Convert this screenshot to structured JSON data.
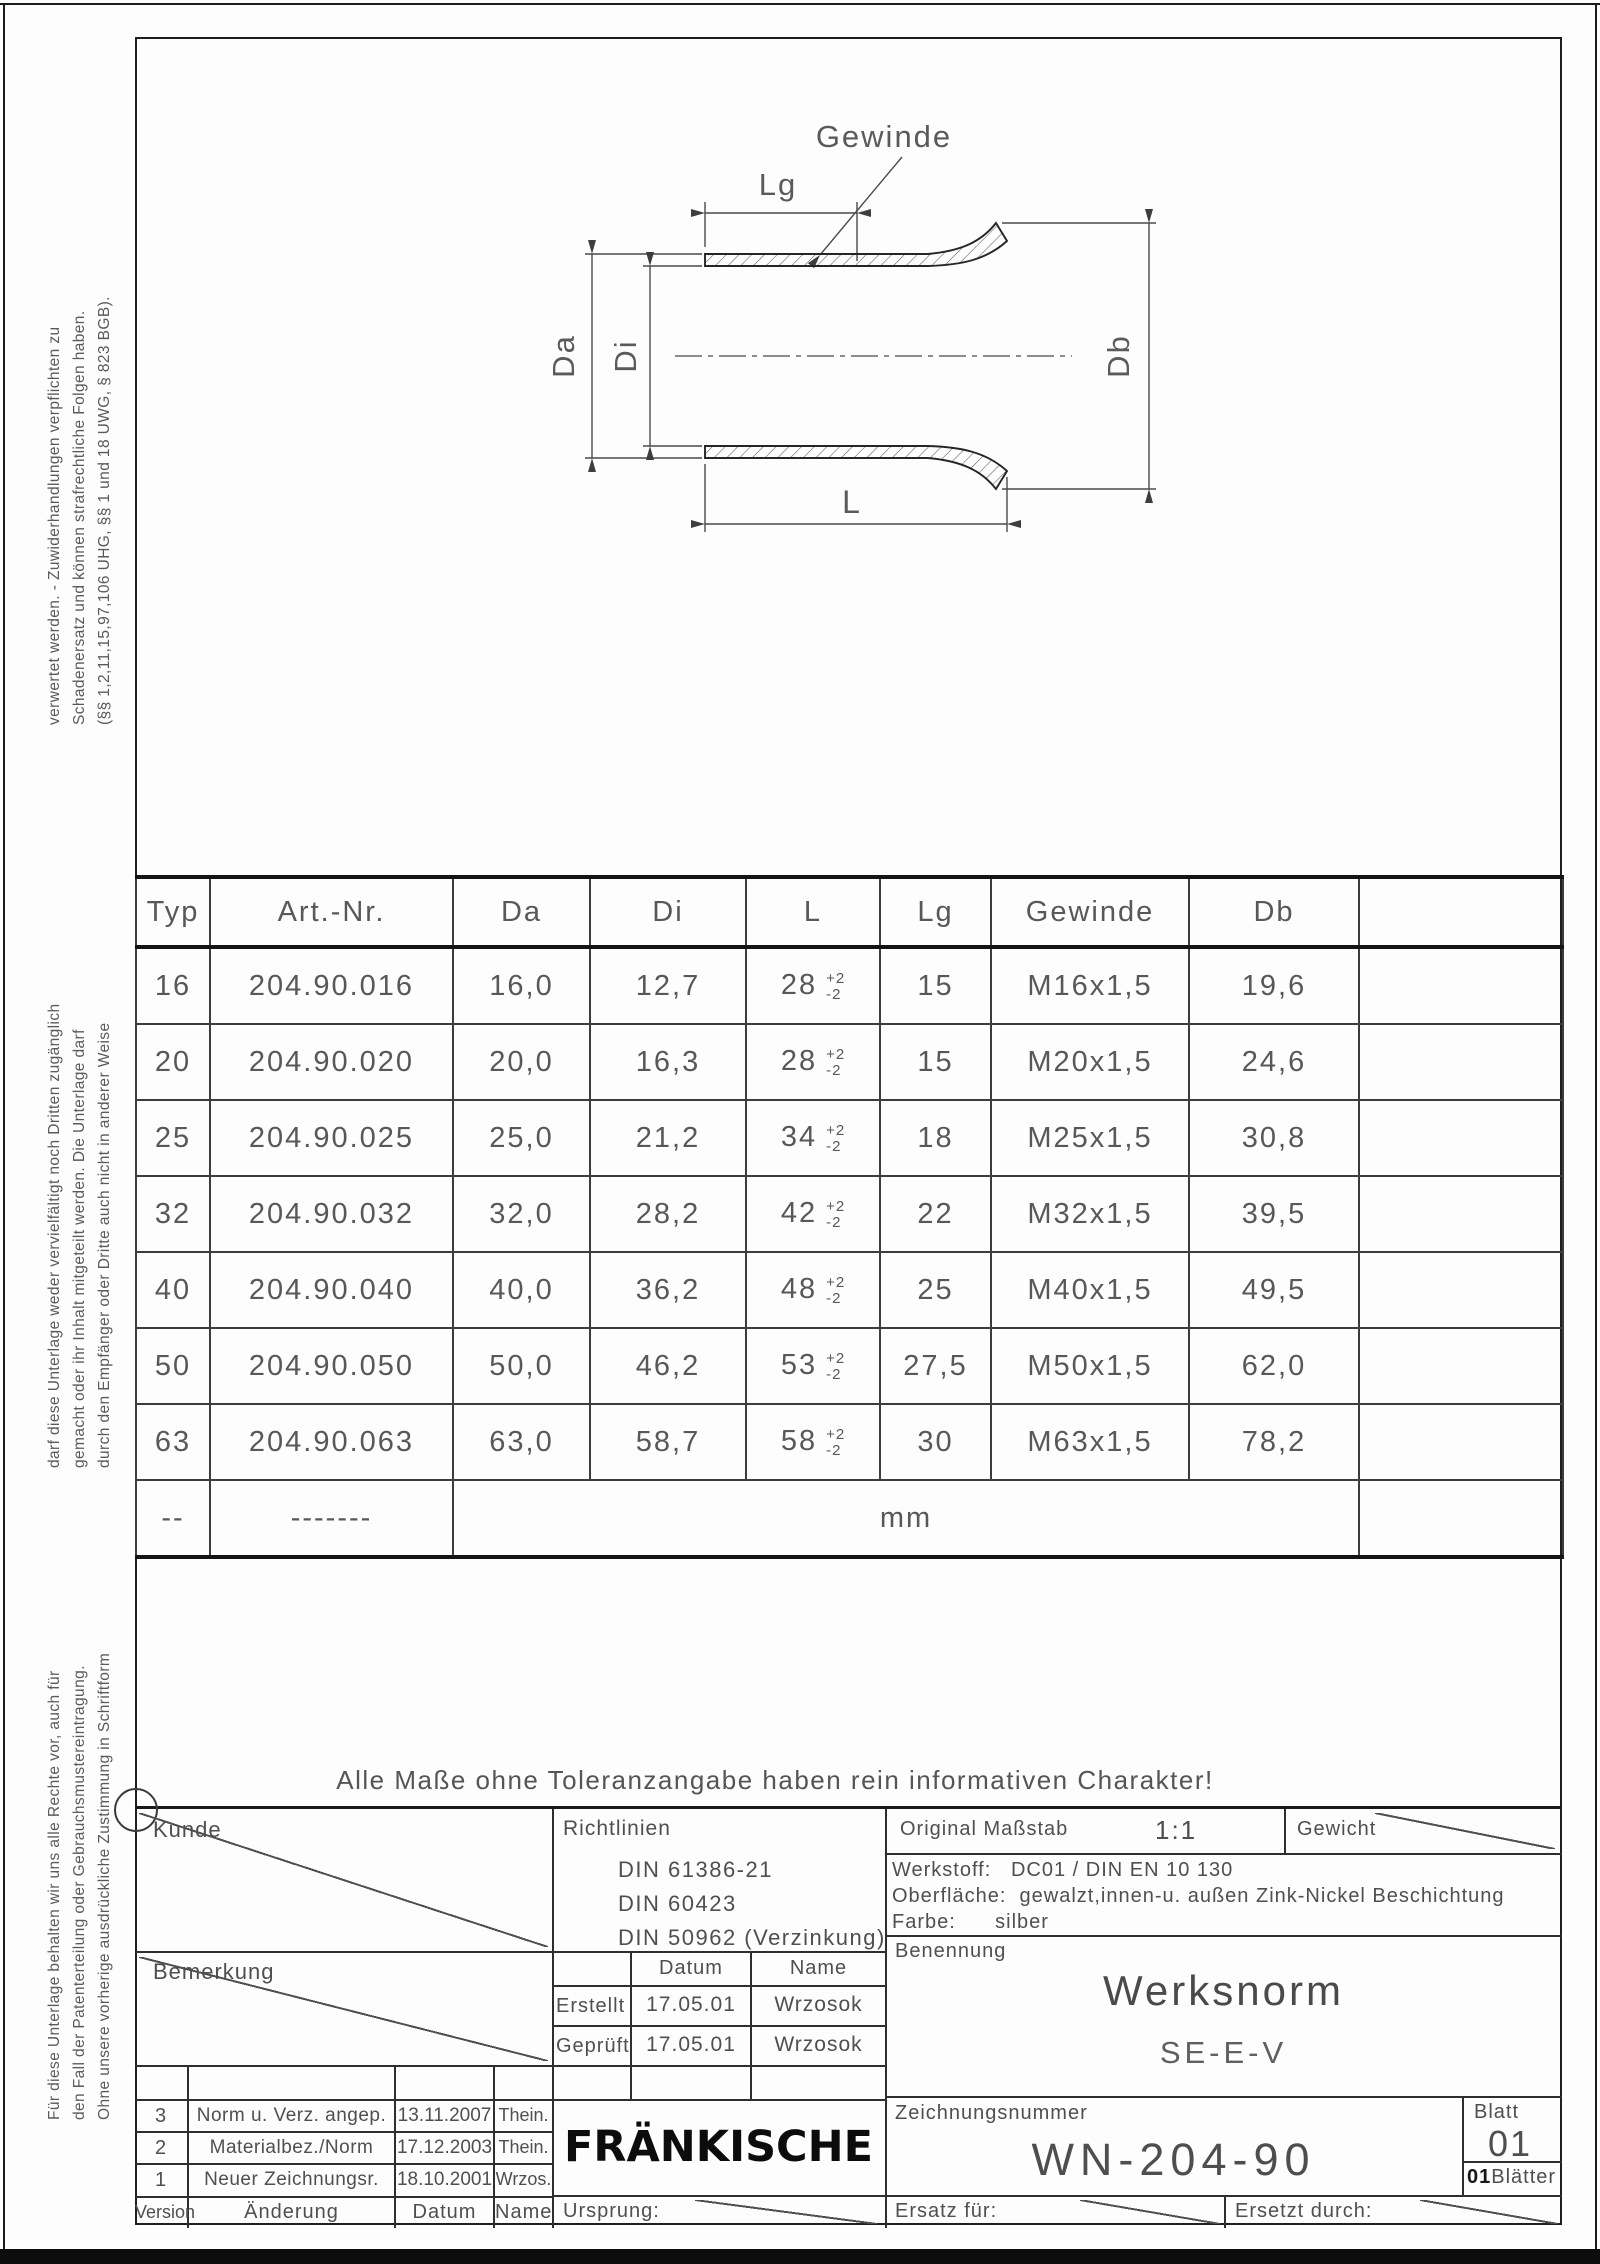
{
  "drawing": {
    "labels": {
      "gewinde": "Gewinde",
      "lg": "Lg",
      "da": "Da",
      "di": "Di",
      "db": "Db",
      "l": "L"
    }
  },
  "left_margin_text": {
    "block_top": [
      "verwertet werden. - Zuwiderhandlungen verpflichten zu",
      "Schadenersatz und können strafrechtliche Folgen haben.",
      "(§§ 1,2,11,15,97,106 UHG, §§ 1 und 18 UWG, § 823 BGB)."
    ],
    "block_middle": [
      "darf diese Unterlage weder vervielfältigt noch Dritten zugänglich",
      "gemacht oder ihr Inhalt mitgeteilt werden. Die Unterlage darf",
      "durch den Empfänger oder Dritte auch nicht in anderer Weise"
    ],
    "block_bottom": [
      "Für diese Unterlage behalten wir uns alle Rechte vor, auch für",
      "den Fall der Patenterteilung oder Gebrauchsmustereintragung.",
      "Ohne unsere vorherige ausdrückliche Zustimmung in Schriftform"
    ]
  },
  "table": {
    "headers": [
      "Typ",
      "Art.-Nr.",
      "Da",
      "Di",
      "L",
      "Lg",
      "Gewinde",
      "Db",
      ""
    ],
    "rows": [
      {
        "typ": "16",
        "art": "204.90.016",
        "da": "16,0",
        "di": "12,7",
        "l": "28",
        "l_tol_plus": "+2",
        "l_tol_minus": "-2",
        "lg": "15",
        "gewinde": "M16x1,5",
        "db": "19,6"
      },
      {
        "typ": "20",
        "art": "204.90.020",
        "da": "20,0",
        "di": "16,3",
        "l": "28",
        "l_tol_plus": "+2",
        "l_tol_minus": "-2",
        "lg": "15",
        "gewinde": "M20x1,5",
        "db": "24,6"
      },
      {
        "typ": "25",
        "art": "204.90.025",
        "da": "25,0",
        "di": "21,2",
        "l": "34",
        "l_tol_plus": "+2",
        "l_tol_minus": "-2",
        "lg": "18",
        "gewinde": "M25x1,5",
        "db": "30,8"
      },
      {
        "typ": "32",
        "art": "204.90.032",
        "da": "32,0",
        "di": "28,2",
        "l": "42",
        "l_tol_plus": "+2",
        "l_tol_minus": "-2",
        "lg": "22",
        "gewinde": "M32x1,5",
        "db": "39,5"
      },
      {
        "typ": "40",
        "art": "204.90.040",
        "da": "40,0",
        "di": "36,2",
        "l": "48",
        "l_tol_plus": "+2",
        "l_tol_minus": "-2",
        "lg": "25",
        "gewinde": "M40x1,5",
        "db": "49,5"
      },
      {
        "typ": "50",
        "art": "204.90.050",
        "da": "50,0",
        "di": "46,2",
        "l": "53",
        "l_tol_plus": "+2",
        "l_tol_minus": "-2",
        "lg": "27,5",
        "gewinde": "M50x1,5",
        "db": "62,0"
      },
      {
        "typ": "63",
        "art": "204.90.063",
        "da": "63,0",
        "di": "58,7",
        "l": "58",
        "l_tol_plus": "+2",
        "l_tol_minus": "-2",
        "lg": "30",
        "gewinde": "M63x1,5",
        "db": "78,2"
      }
    ],
    "footer": {
      "typ": "--",
      "art": "-------",
      "unit": "mm"
    }
  },
  "notice": "Alle Maße ohne Toleranzangabe haben rein informativen Charakter!",
  "title_block": {
    "kunde_label": "Kunde",
    "richtlinien_label": "Richtlinien",
    "richtlinien": [
      "DIN 61386-21",
      "DIN 60423",
      "DIN 50962 (Verzinkung)"
    ],
    "masstab_label": "Original Maßstab",
    "masstab_value": "1:1",
    "gewicht_label": "Gewicht",
    "werkstoff_label": "Werkstoff:",
    "werkstoff_value": "DC01 / DIN EN 10 130",
    "oberflaeche_label": "Oberfläche:",
    "oberflaeche_value": "gewalzt,innen-u. außen Zink-Nickel Beschichtung",
    "farbe_label": "Farbe:",
    "farbe_value": "silber",
    "bemerkung_label": "Bemerkung",
    "approval": {
      "datum_label": "Datum",
      "name_label": "Name",
      "rows": [
        {
          "label": "Erstellt",
          "datum": "17.05.01",
          "name": "Wrzosok"
        },
        {
          "label": "Geprüft",
          "datum": "17.05.01",
          "name": "Wrzosok"
        }
      ]
    },
    "benennung_label": "Benennung",
    "benennung_title": "Werksnorm",
    "benennung_subtitle": "SE-E-V",
    "logo_text": "FRÄNKISCHE",
    "zeichnungsnummer_label": "Zeichnungsnummer",
    "zeichnungsnummer_value": "WN-204-90",
    "blatt_label": "Blatt",
    "blatt_value": "01",
    "blaetter_count": "01",
    "blaetter_label": "Blätter",
    "ursprung_label": "Ursprung:",
    "ersatz_label": "Ersatz für:",
    "ersetzt_label": "Ersetzt durch:",
    "versions": {
      "headers": {
        "version": "Version",
        "aenderung": "Änderung",
        "datum": "Datum",
        "name": "Name"
      },
      "rows": [
        {
          "version": "3",
          "aenderung": "Norm u. Verz. angep.",
          "datum": "13.11.2007",
          "name": "Thein."
        },
        {
          "version": "2",
          "aenderung": "Materialbez./Norm",
          "datum": "17.12.2003",
          "name": "Thein."
        },
        {
          "version": "1",
          "aenderung": "Neuer Zeichnungsr.",
          "datum": "18.10.2001",
          "name": "Wrzos."
        }
      ]
    }
  }
}
